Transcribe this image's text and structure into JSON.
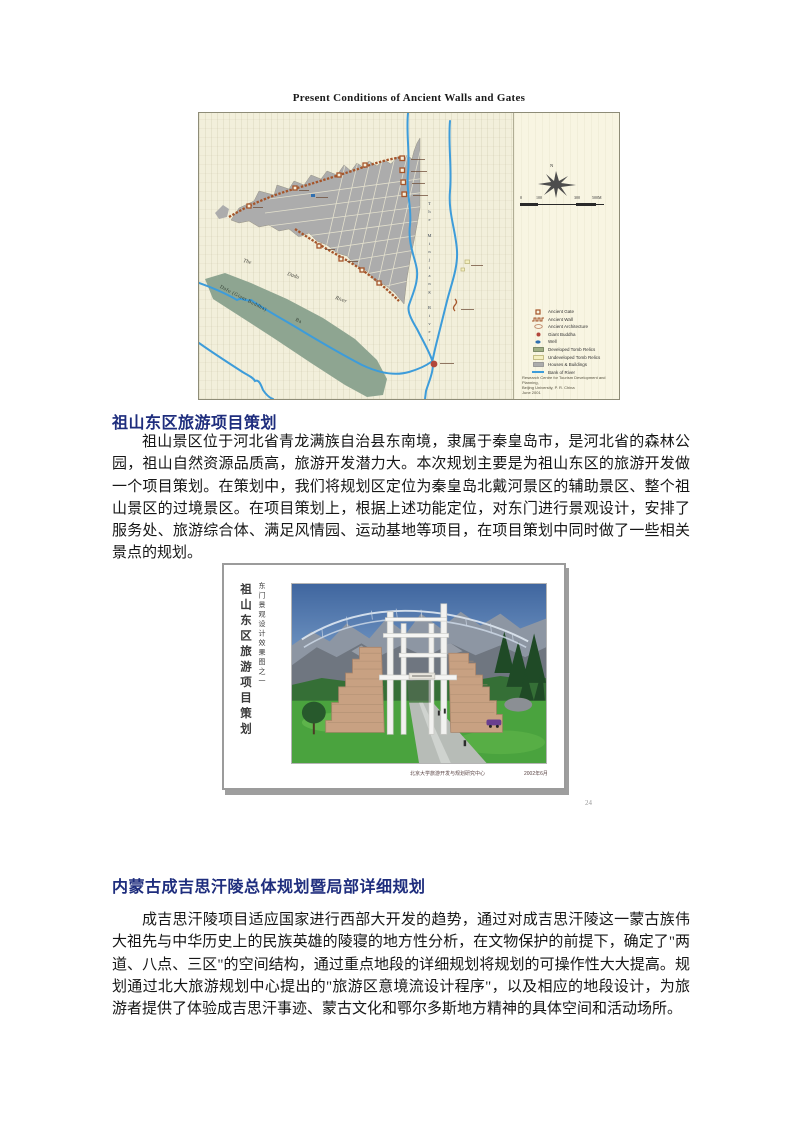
{
  "map_figure": {
    "title": "Present Conditions of Ancient Walls and Gates",
    "labels": {
      "minjiang_river": "The Minjiang River",
      "dadu_the": "The",
      "dadu_name": "Dadu",
      "dadu_river": "River",
      "green_bar": "Dafo (Giant Buddha)",
      "green_bar_ba": "Ba",
      "compass_n": "N"
    },
    "scale": {
      "ticks": [
        "0",
        "100",
        "300",
        "500M"
      ]
    },
    "legend": {
      "items": [
        {
          "label": "Ancient Gate",
          "icon": "gate-icon",
          "color": "#A5552A"
        },
        {
          "label": "Ancient Wall",
          "icon": "wall-icon",
          "color": "#A5552A"
        },
        {
          "label": "Ancient Architecture",
          "icon": "architecture-icon",
          "color": "#C08A6A"
        },
        {
          "label": "Giant Buddha",
          "icon": "buddha-icon",
          "color": "#B2463B"
        },
        {
          "label": "Well",
          "icon": "well-icon",
          "color": "#2F6FB0"
        },
        {
          "label": "Developed Tomb Relics",
          "icon": "developed-tomb-swatch",
          "color": "#9FAE84"
        },
        {
          "label": "Undeveloped Tomb Relics",
          "icon": "undeveloped-tomb-swatch",
          "color": "#F4F0C0"
        },
        {
          "label": "Houses & Buildings",
          "icon": "buildings-swatch",
          "color": "#ACACAC"
        },
        {
          "label": "Bank of River",
          "icon": "river-line-icon",
          "color": "#3D9CDA"
        }
      ]
    },
    "credit_line1": "Research Centre for Tourism Development and Planning,",
    "credit_line2": "Beijing University, P. R. China",
    "credit_line3": "June 2001"
  },
  "section1": {
    "heading": "祖山东区旅游项目策划",
    "paragraph": "祖山景区位于河北省青龙满族自治县东南境，隶属于秦皇岛市，是河北省的森林公园，祖山自然资源品质高，旅游开发潜力大。本次规划主要是为祖山东区的旅游开发做一个项目策划。在策划中，我们将规划区定位为秦皇岛北戴河景区的辅助景区、整个祖山景区的过境景区。在项目策划上，根据上述功能定位，对东门进行景观设计，安排了服务处、旅游综合体、满足风情园、运动基地等项目，在项目策划中同时做了一些相关景点的规划。"
  },
  "slide_figure": {
    "side_title_large": "祖山东区旅游项目策划",
    "side_title_small": "东门景观设计效果图之一",
    "caption": "北京大学旅游开发与规划研究中心",
    "caption_date": "2002年6月",
    "page_number": "24"
  },
  "section2": {
    "heading": "内蒙古成吉思汗陵总体规划暨局部详细规划",
    "paragraph": "成吉思汗陵项目适应国家进行西部大开发的趋势，通过对成吉思汗陵这一蒙古族伟大祖先与中华历史上的民族英雄的陵寝的地方性分析，在文物保护的前提下，确定了\"两道、八点、三区\"的空间结构，通过重点地段的详细规划将规划的可操作性大大提高。规划通过北大旅游规划中心提出的\"旅游区意境流设计程序\"，以及相应的地段设计，为旅游者提供了体验成吉思汗事迹、蒙古文化和鄂尔多斯地方精神的具体空间和活动场所。"
  }
}
